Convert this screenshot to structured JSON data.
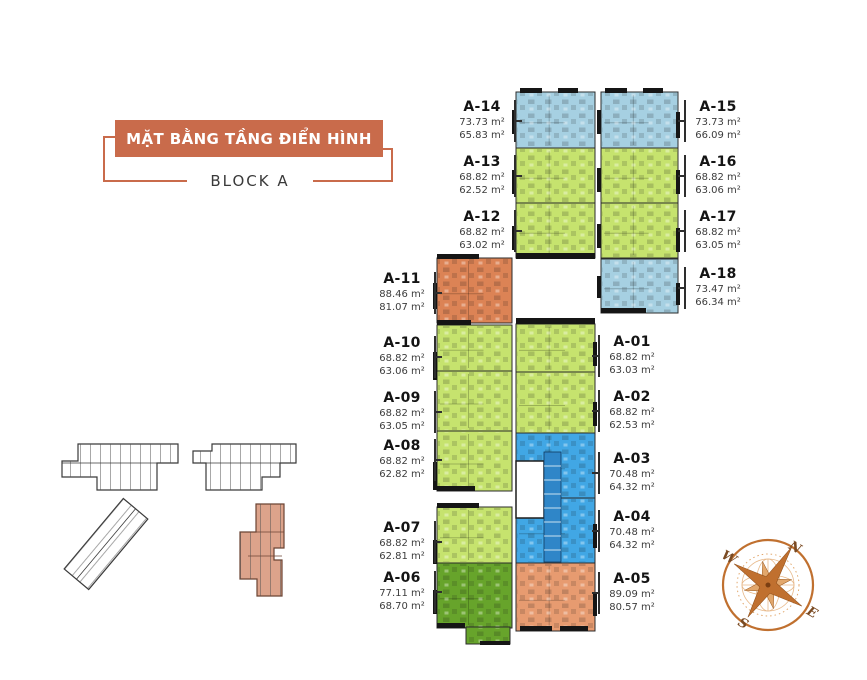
{
  "header": {
    "title": "MẶT BẰNG TẦNG ĐIỂN HÌNH",
    "block": "BLOCK A"
  },
  "units": [
    {
      "id": "A-01",
      "gross": "68.82 m²",
      "net": "63.03 m²",
      "color": "lime"
    },
    {
      "id": "A-02",
      "gross": "68.82 m²",
      "net": "62.53 m²",
      "color": "lime"
    },
    {
      "id": "A-03",
      "gross": "70.48 m²",
      "net": "64.32 m²",
      "color": "brightBlue"
    },
    {
      "id": "A-04",
      "gross": "70.48 m²",
      "net": "64.32 m²",
      "color": "brightBlue"
    },
    {
      "id": "A-05",
      "gross": "89.09 m²",
      "net": "80.57 m²",
      "color": "salmonLight"
    },
    {
      "id": "A-06",
      "gross": "77.11 m²",
      "net": "68.70 m²",
      "color": "darkGreen"
    },
    {
      "id": "A-07",
      "gross": "68.82 m²",
      "net": "62.81 m²",
      "color": "lime"
    },
    {
      "id": "A-08",
      "gross": "68.82 m²",
      "net": "62.82 m²",
      "color": "lime"
    },
    {
      "id": "A-09",
      "gross": "68.82 m²",
      "net": "63.05 m²",
      "color": "lime"
    },
    {
      "id": "A-10",
      "gross": "68.82 m²",
      "net": "63.06 m²",
      "color": "lime"
    },
    {
      "id": "A-11",
      "gross": "88.46 m²",
      "net": "81.07 m²",
      "color": "salmon"
    },
    {
      "id": "A-12",
      "gross": "68.82 m²",
      "net": "63.02 m²",
      "color": "lime"
    },
    {
      "id": "A-13",
      "gross": "68.82 m²",
      "net": "62.52 m²",
      "color": "lime"
    },
    {
      "id": "A-14",
      "gross": "73.73 m²",
      "net": "65.83 m²",
      "color": "lightBlue"
    },
    {
      "id": "A-15",
      "gross": "73.73 m²",
      "net": "66.09 m²",
      "color": "lightBlue"
    },
    {
      "id": "A-16",
      "gross": "68.82 m²",
      "net": "63.06 m²",
      "color": "lime"
    },
    {
      "id": "A-17",
      "gross": "68.82 m²",
      "net": "63.05 m²",
      "color": "lime"
    },
    {
      "id": "A-18",
      "gross": "73.47 m²",
      "net": "66.34 m²",
      "color": "lightBlue"
    }
  ],
  "compass": {
    "n": "N",
    "e": "E",
    "s": "S",
    "w": "W"
  },
  "colors": {
    "titleOrange": "#C96B4B",
    "lightBlue": "#A6D0E2",
    "lime": "#C6E36E",
    "brightBlue": "#41A7E5",
    "salmon": "#DC8355",
    "salmonLight": "#E79B70",
    "darkGreen": "#67A42B",
    "coreBlue": "#2F86C8",
    "keyplanFill": "#DCA38B",
    "compassOrange": "#C0702F",
    "compassLight": "#E2A76C"
  }
}
